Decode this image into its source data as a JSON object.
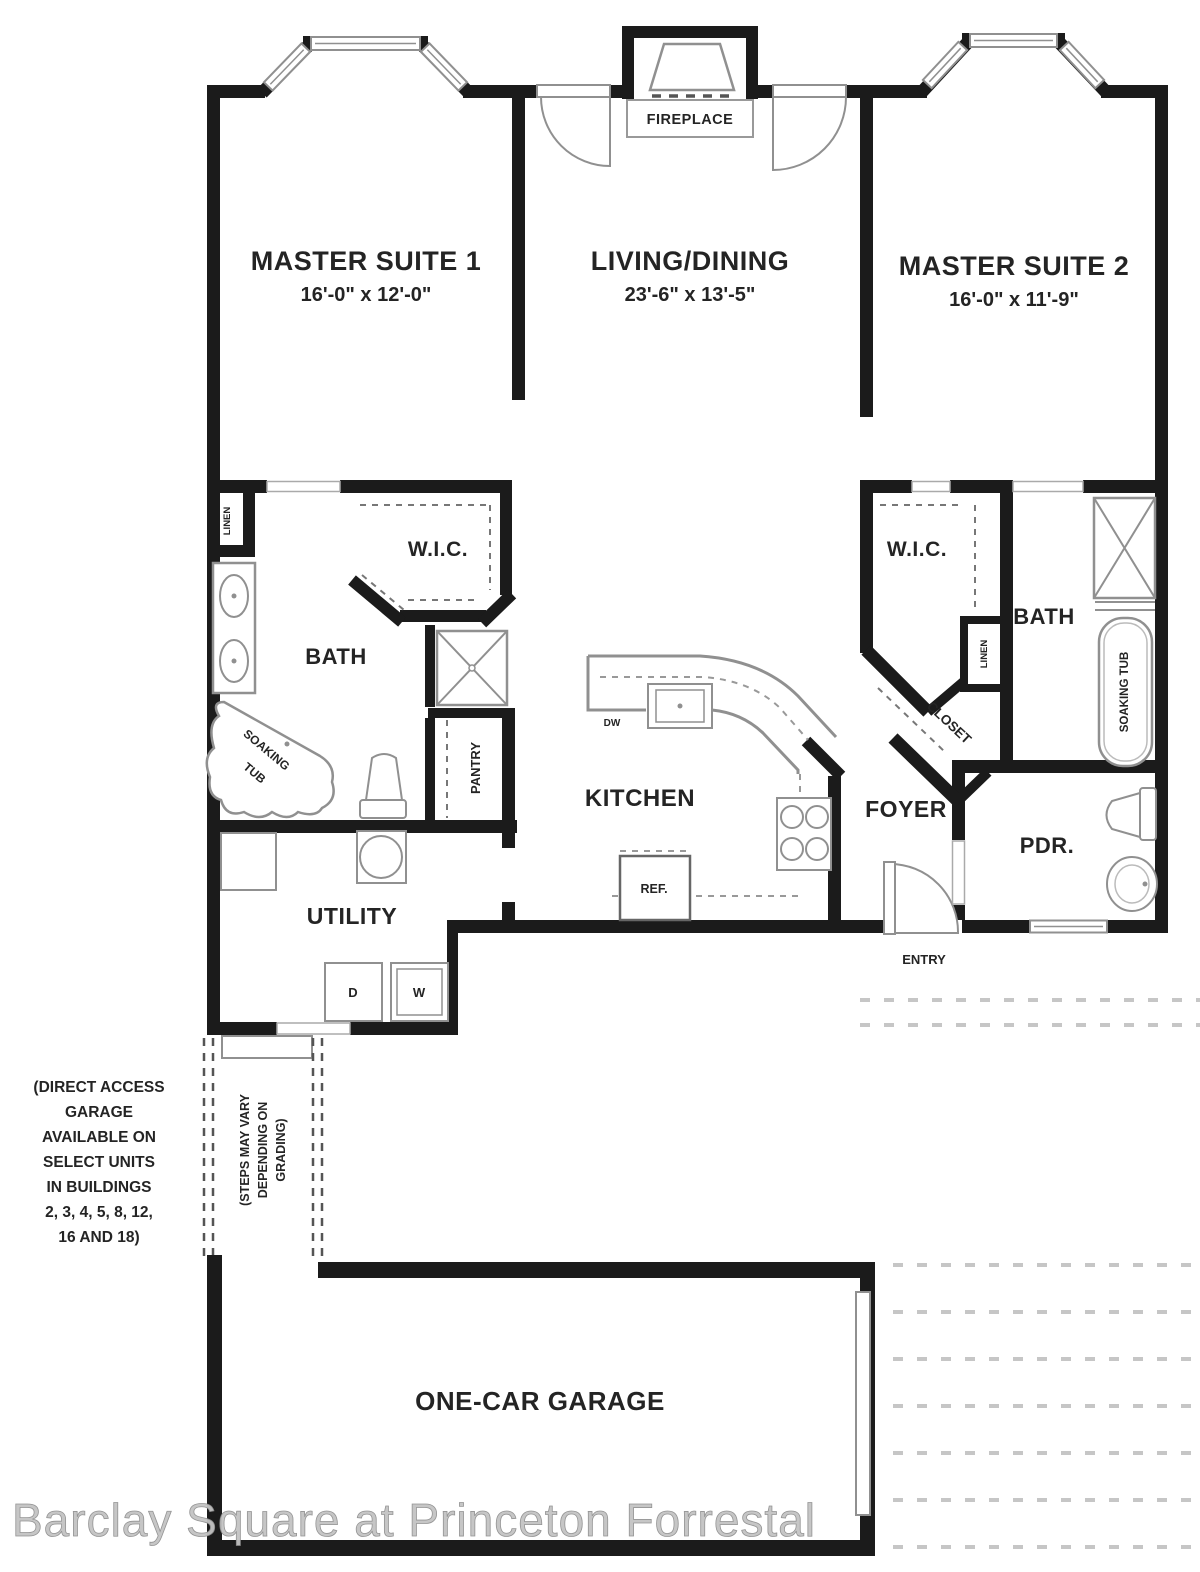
{
  "plan": {
    "rooms": {
      "master_suite_1": {
        "label": "MASTER SUITE 1",
        "dims": "16'-0\" x 12'-0\""
      },
      "living_dining": {
        "label": "LIVING/DINING",
        "dims": "23'-6\" x 13'-5\""
      },
      "master_suite_2": {
        "label": "MASTER SUITE 2",
        "dims": "16'-0\" x 11'-9\""
      },
      "bath_left": {
        "label": "BATH"
      },
      "wic_left": {
        "label": "W.I.C."
      },
      "pantry": {
        "label": "PANTRY"
      },
      "kitchen": {
        "label": "KITCHEN"
      },
      "foyer": {
        "label": "FOYER"
      },
      "utility": {
        "label": "UTILITY"
      },
      "wic_right": {
        "label": "W.I.C."
      },
      "bath_right": {
        "label": "BATH"
      },
      "closet": {
        "label": "CLOSET"
      },
      "linen_left": {
        "label": "LINEN"
      },
      "linen_right": {
        "label": "LINEN"
      },
      "pdr": {
        "label": "PDR."
      },
      "entry": {
        "label": "ENTRY"
      },
      "fireplace": {
        "label": "FIREPLACE"
      },
      "garage": {
        "label": "ONE-CAR GARAGE"
      }
    },
    "fixtures": {
      "soaking_tub_left_line1": "SOAKING",
      "soaking_tub_left_line2": "TUB",
      "soaking_tub_right": "SOAKING TUB",
      "dishwasher": "DW",
      "refrigerator": "REF.",
      "dryer": "D",
      "washer": "W"
    },
    "notes": {
      "direct_access_lines": [
        "(DIRECT ACCESS",
        "GARAGE",
        "AVAILABLE ON",
        "SELECT UNITS",
        "IN BUILDINGS",
        "2, 3, 4, 5, 8, 12,",
        "16 AND 18)"
      ],
      "steps_lines": [
        "(STEPS MAY VARY",
        "DEPENDING ON",
        "GRADING)"
      ]
    },
    "watermark": "Barclay Square at Princeton Forrestal",
    "colors": {
      "wall": "#1b1b1b",
      "fixture": "#909090",
      "text": "#242424",
      "watermark": "#c3c3c3"
    }
  }
}
